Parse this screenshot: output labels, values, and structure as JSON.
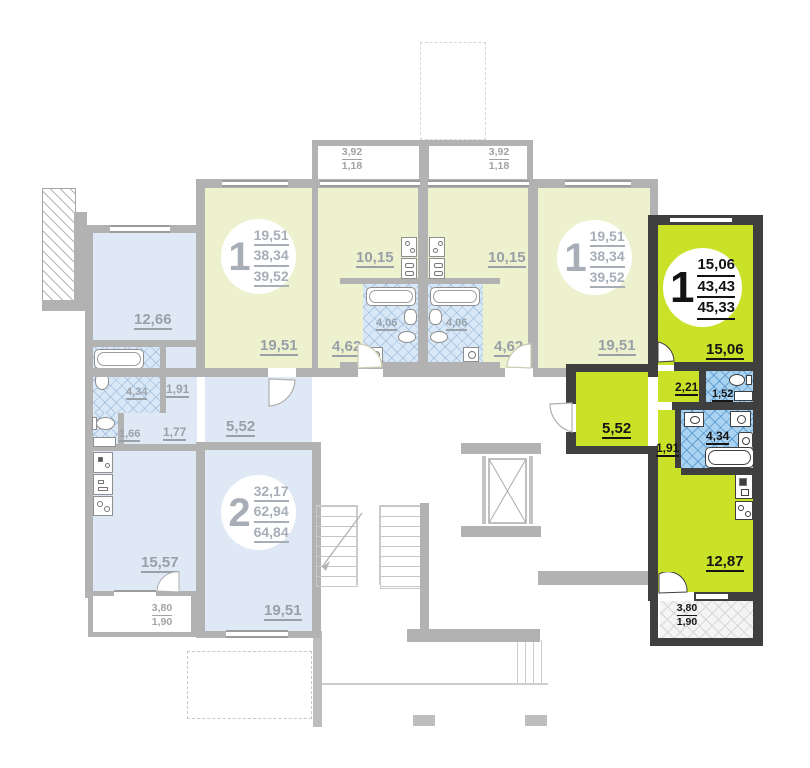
{
  "plan_title": "Floor plan — apartment section",
  "units": [
    {
      "id": "one-room-left-faded",
      "badge": "1",
      "areas": [
        "19,51",
        "38,34",
        "39,52"
      ],
      "rooms": {
        "living": "19,51",
        "kitchen": "10,15",
        "hall": "4,62",
        "bath": "4,06"
      },
      "balcony": {
        "full": "3,92",
        "half": "1,18"
      }
    },
    {
      "id": "one-room-right-faded",
      "badge": "1",
      "areas": [
        "19,51",
        "38,34",
        "39,52"
      ],
      "rooms": {
        "living": "19,51",
        "kitchen": "10,15",
        "hall": "4,62",
        "bath": "4,06"
      },
      "balcony": {
        "full": "3,92",
        "half": "1,18"
      }
    },
    {
      "id": "two-room-faded",
      "badge": "2",
      "areas": [
        "32,17",
        "62,94",
        "64,84"
      ],
      "rooms": {
        "room1": "12,66",
        "room2": "19,51",
        "kitchen": "15,57",
        "bath": "4,34",
        "wc": "1,66",
        "hall1": "1,77",
        "hall2": "1,91",
        "hall3": "5,52"
      },
      "balcony": {
        "full": "3,80",
        "half": "1,90"
      }
    },
    {
      "id": "one-room-highlighted",
      "badge": "1",
      "areas": [
        "15,06",
        "43,43",
        "45,33"
      ],
      "rooms": {
        "living": "15,06",
        "kitchen": "12,87",
        "bath": "4,34",
        "wc": "1,52",
        "hall1": "2,21",
        "hall2": "1,91",
        "hall3": "5,52"
      },
      "balcony": {
        "full": "3,80",
        "half": "1,90"
      }
    }
  ],
  "colors": {
    "highlight_fill": "#c9e227",
    "highlight_wall": "#3f3f3f",
    "faded_yellow": "#edf1cd",
    "faded_blue": "#dfe9f6",
    "tile_blue": "#a9d3f0",
    "wall_gray": "#b2b2b2",
    "label_gray": "#98a0a8",
    "label_black": "#151515"
  },
  "icons": {
    "bathtub": "rounded-rect",
    "toilet": "ellipse+tank",
    "sink": "small-oval",
    "stove": "square-with-burners",
    "washer": "square-with-drum",
    "elevator": "rect-with-x-cross",
    "stairs": "stepped-lines-with-arrow",
    "door": "quarter-arc-wedge"
  }
}
